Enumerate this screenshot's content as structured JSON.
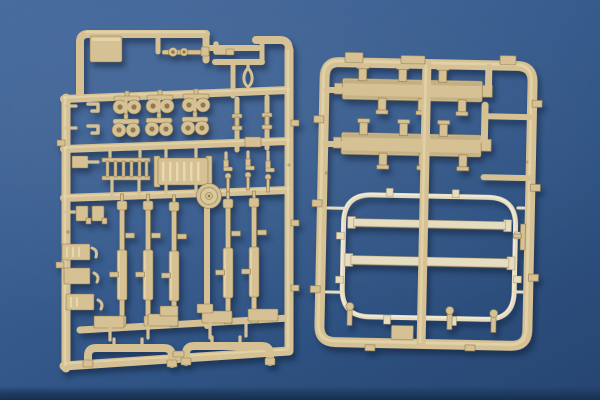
{
  "meta": {
    "type": "photograph",
    "description": "Product photo of two tan injection-molded plastic model-kit sprues (part trees) lying on a blue background",
    "image_width_px": 600,
    "image_height_px": 400
  },
  "colors": {
    "background_top": "#43689c",
    "background_mid": "#365b8d",
    "background_bottom": "#274571",
    "floor_shadow": "#16304f",
    "sprue_base": "#d5c194",
    "sprue_light": "#ecdfb6",
    "sprue_dark": "#8f7a4e",
    "frame_part_light": "#e6dcbf",
    "frame_part_highlight": "#f4eedd"
  },
  "scene": {
    "left_sprue": {
      "label": "left parts sprue",
      "contents": [
        "solid corner block",
        "rod part with rings",
        "elbow fittings",
        "teardrop shackle",
        "eyelet pairs (6)",
        "hook parts (2)",
        "bobbin posts (2)",
        "ladder grille",
        "ribbed box",
        "boot brackets (3)",
        "bolt pins (3)",
        "round disc hub",
        "long suspension rods (5)",
        "side brackets and ribbed blocks (5)",
        "mounting pads (4)",
        "U-shaped exhaust pipes (2)"
      ]
    },
    "right_sprue": {
      "label": "right parts sprue",
      "contents": [
        "slatted side boards (2)",
        "clamp tabs (12)",
        "rounded rectangular frame",
        "frame cross bars (2)",
        "frame edge nubs (8)",
        "small cap pins (3)",
        "corner tab blocks (2)",
        "side L-bracket"
      ]
    }
  }
}
